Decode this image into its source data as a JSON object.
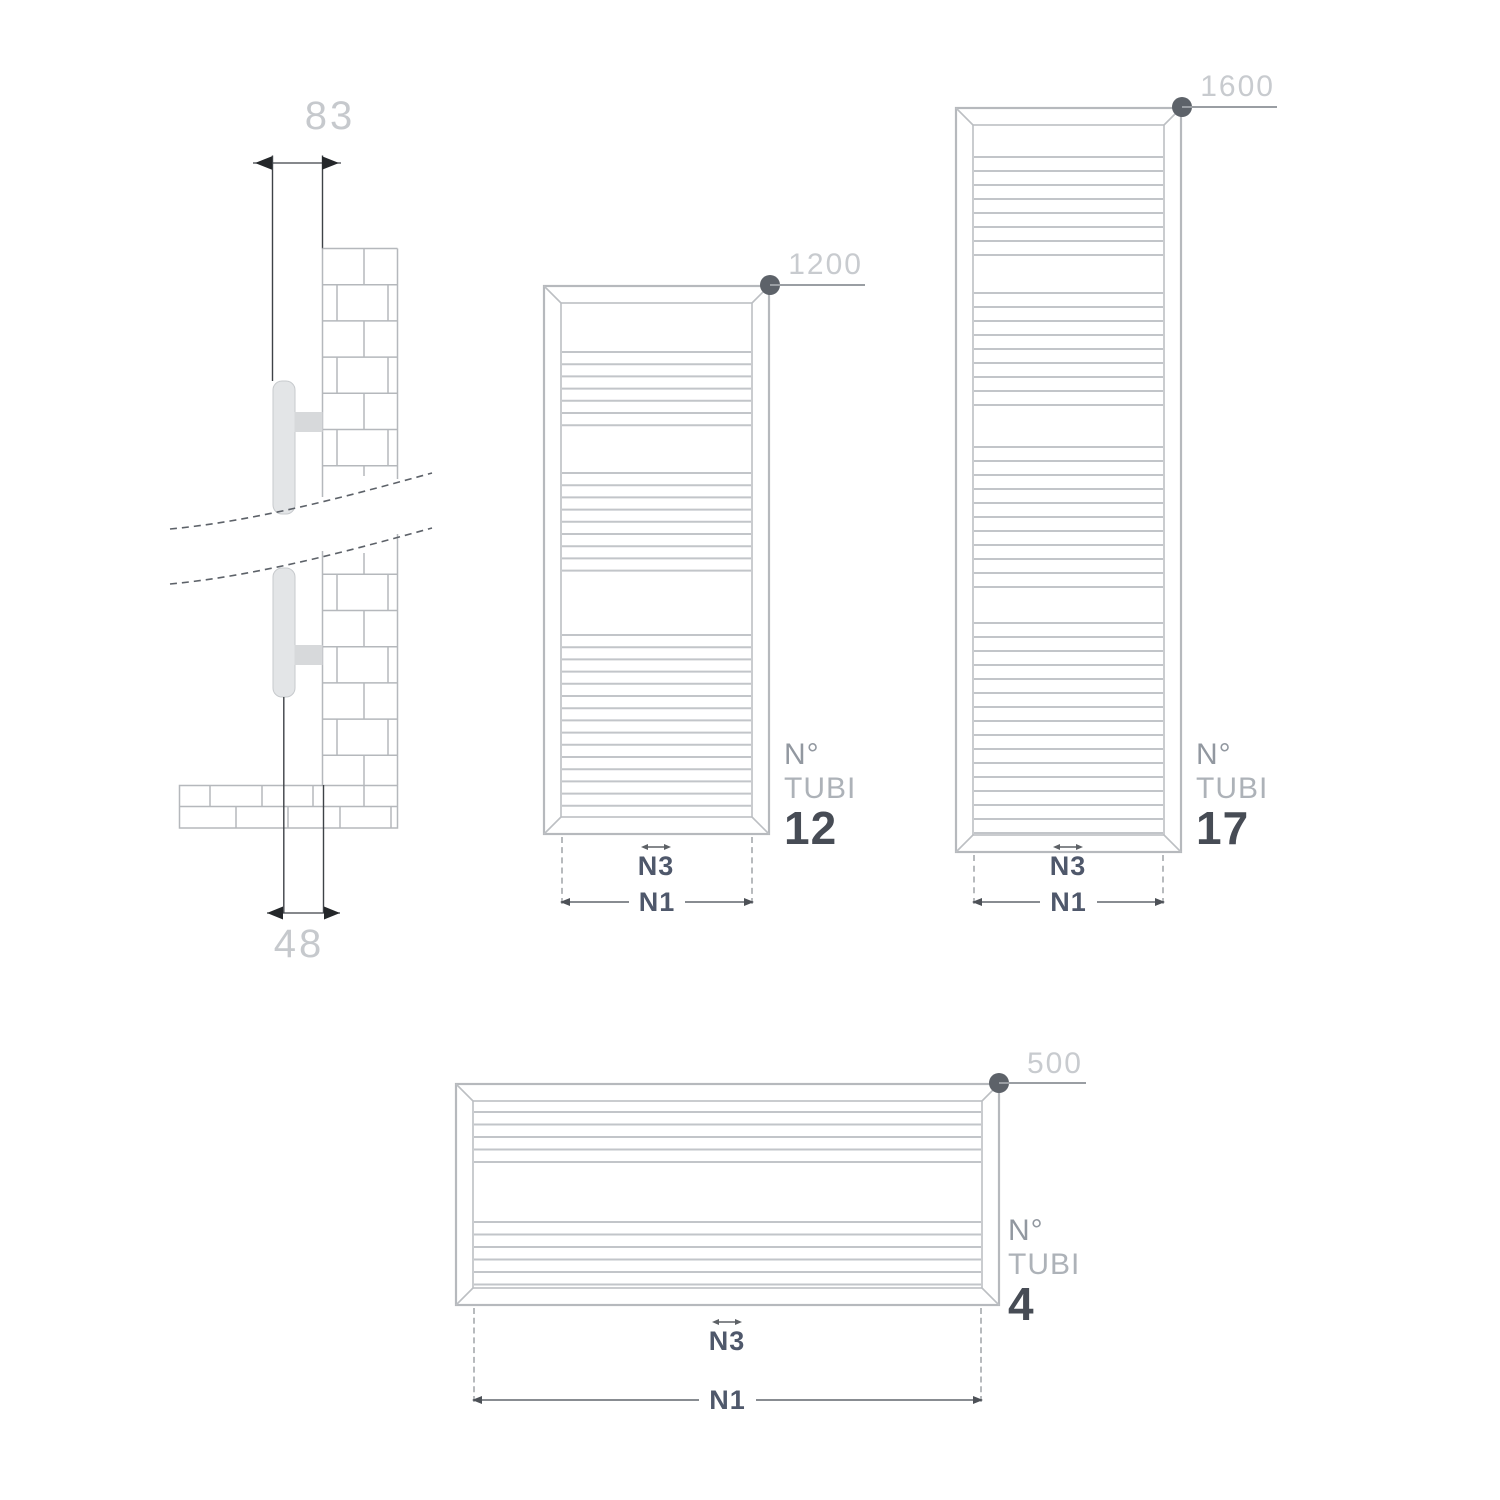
{
  "side_view": {
    "depth_label": "83",
    "axis_label": "48"
  },
  "radiators": [
    {
      "height_label": "1200",
      "tubi_label_line1": "N°",
      "tubi_label_line2": "TUBI",
      "tubi_count": "12",
      "n3_label": "N3",
      "n1_label": "N1",
      "tube_group_line_counts": [
        7,
        9,
        15
      ]
    },
    {
      "height_label": "1600",
      "tubi_label_line1": "N°",
      "tubi_label_line2": "TUBI",
      "tubi_count": "17",
      "n3_label": "N3",
      "n1_label": "N1",
      "tube_group_line_counts": [
        8,
        9,
        11,
        16
      ]
    },
    {
      "height_label": "500",
      "tubi_label_line1": "N°",
      "tubi_label_line2": "TUBI",
      "tubi_count": "4",
      "n3_label": "N3",
      "n1_label": "N1",
      "tube_group_line_counts": [
        5,
        6
      ]
    }
  ],
  "colors": {
    "frame_gray": "#b9bcc0",
    "tube_gray": "#c2c5c9",
    "dim_text_light": "#c6c9cd",
    "tubi_no_gray": "#9298a0",
    "tubi_word_gray": "#adb2b8",
    "tubi_count_dark": "#474c55",
    "n_label_slate": "#4f586b",
    "dot_dark": "#5d6269",
    "dark_line": "#3e4247"
  }
}
